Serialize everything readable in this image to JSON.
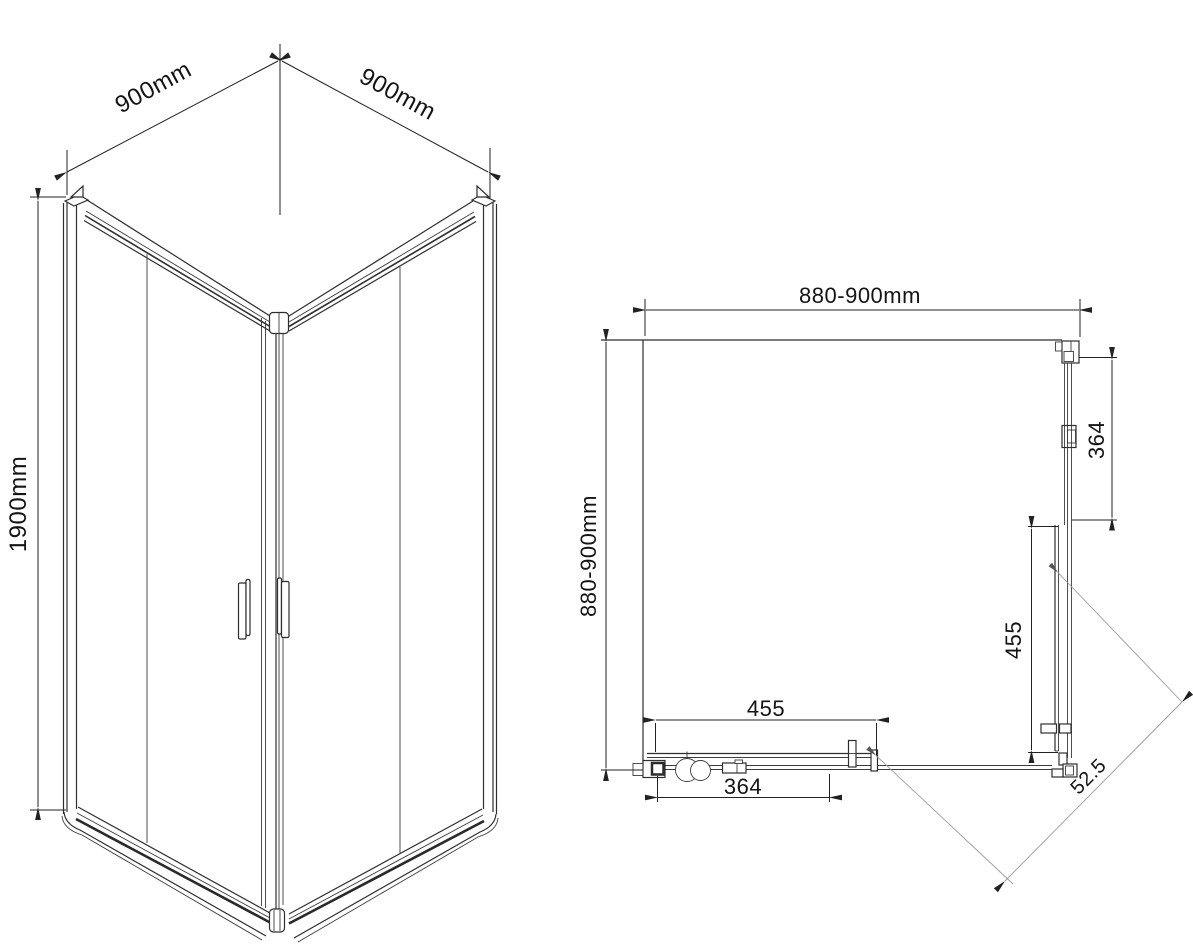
{
  "iso_view": {
    "dim_width_left": "900mm",
    "dim_width_right": "900mm",
    "dim_height": "1900mm"
  },
  "plan_view": {
    "dim_width_top": "880-900mm",
    "dim_depth_left": "880-900mm",
    "dim_right_upper": "364",
    "dim_right_lower": "455",
    "dim_bottom_upper": "455",
    "dim_bottom_lower": "364",
    "dim_diagonal": "52.5"
  }
}
